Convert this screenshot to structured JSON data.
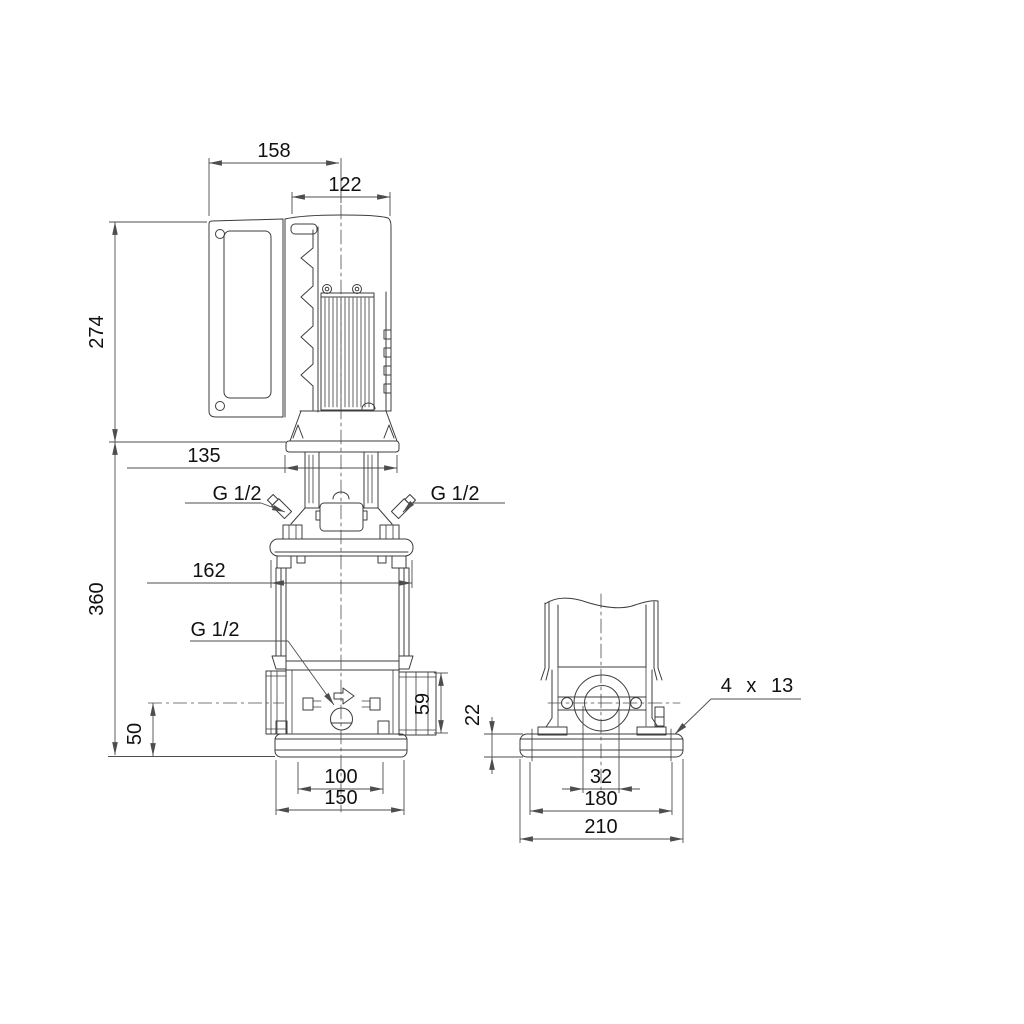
{
  "drawing": {
    "front_view": {
      "dim_158": "158",
      "dim_122": "122",
      "dim_274": "274",
      "dim_135": "135",
      "port_top_left": "G 1/2",
      "port_top_right": "G 1/2",
      "dim_162": "162",
      "dim_360": "360",
      "drain_port": "G 1/2",
      "dim_50": "50",
      "dim_59": "59",
      "dim_100": "100",
      "dim_150": "150"
    },
    "side_view": {
      "dim_22": "22",
      "bolt_holes": "4 x 13",
      "dim_32": "32",
      "dim_180": "180",
      "dim_210": "210"
    },
    "colors": {
      "background": "#ffffff",
      "part_lines": "#3c3c3c",
      "dimension_lines": "#4d4d4d",
      "text": "#111111"
    }
  }
}
